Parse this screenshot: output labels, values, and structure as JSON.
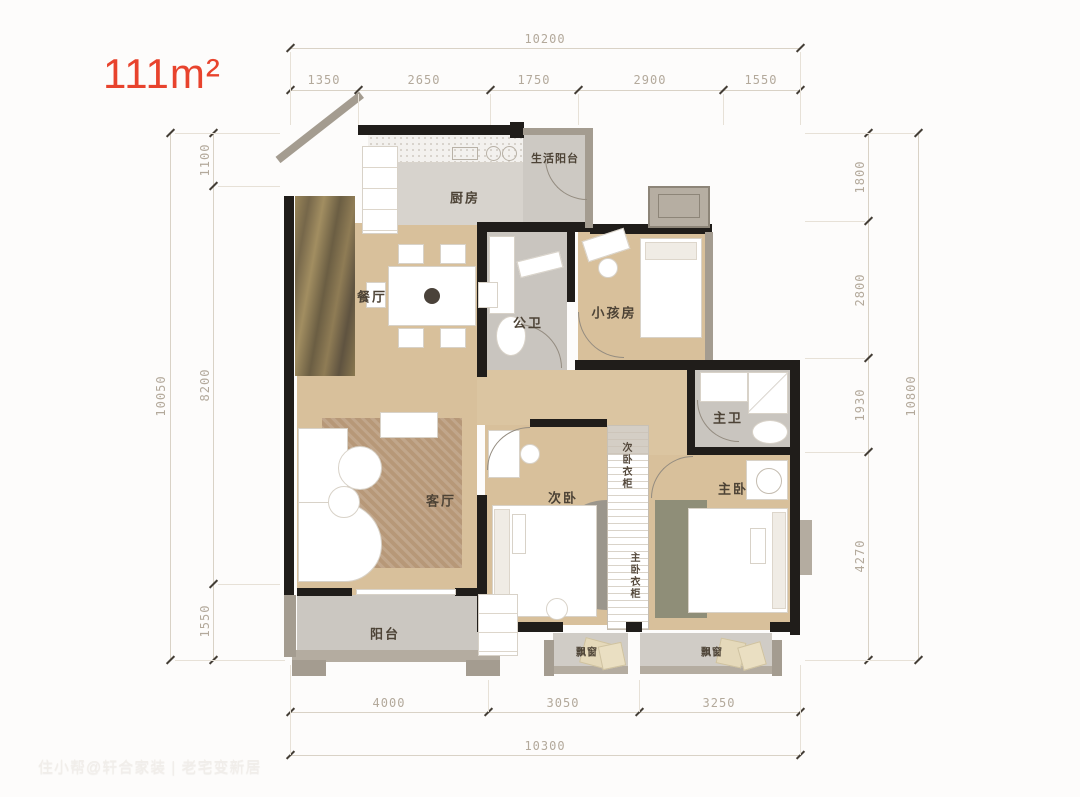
{
  "title": {
    "area": "111m²"
  },
  "watermark": "住小帮@轩合家装 | 老宅变新居",
  "rooms": {
    "service_balcony": "生活阳台",
    "kitchen": "厨房",
    "dining": "餐厅",
    "public_bath": "公卫",
    "kids_room": "小孩房",
    "master_bath": "主卫",
    "living": "客厅",
    "second_bedroom": "次卧",
    "second_wardrobe": "次卧衣柜",
    "master_wardrobe": "主卧衣柜",
    "master_bedroom": "主卧",
    "balcony": "阳台",
    "bay_window": "飘窗"
  },
  "dimensions": {
    "top": {
      "total": "10200",
      "segments": [
        "1350",
        "2650",
        "1750",
        "2900",
        "1550"
      ]
    },
    "bottom": {
      "total": "10300",
      "segments": [
        "4000",
        "3050",
        "3250"
      ]
    },
    "left": {
      "total": "10050",
      "segments": [
        "1100",
        "8200",
        "1550"
      ]
    },
    "right": {
      "total": "10800",
      "segments": [
        "1800",
        "2800",
        "1930",
        "4270"
      ]
    }
  },
  "colors": {
    "accent": "#e8432d",
    "wall": "#201d1a",
    "wood_floor": "#d8c09b",
    "wet_floor": "#c9c5bf",
    "dimension_text": "#b3a99b"
  }
}
